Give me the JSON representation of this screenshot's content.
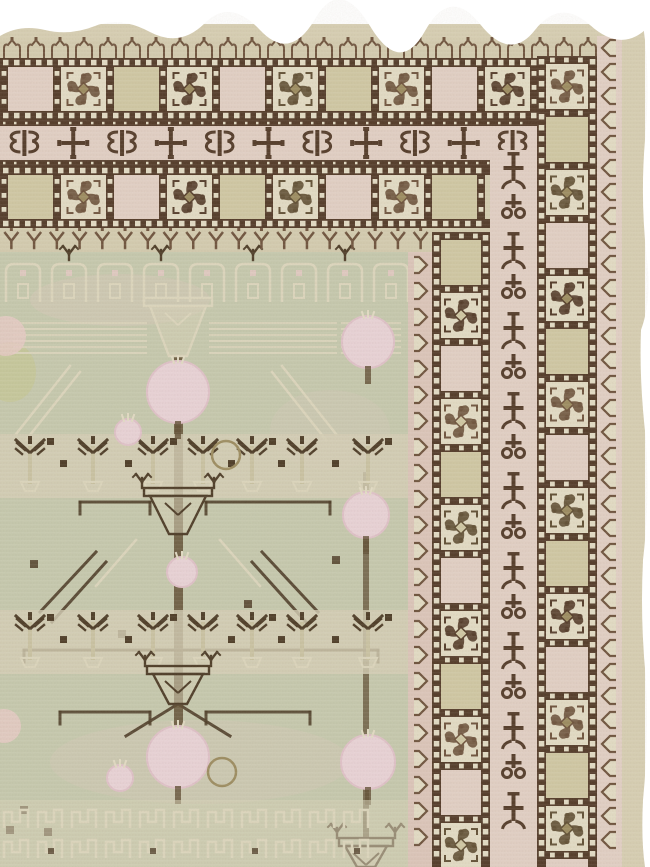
{
  "meta": {
    "subject": "Antique Khotan Samarkand carpet, corner detail",
    "alt": "Corner fragment of an antique pale-green Khotan rug with pomegranate-tree field, pink-ground borders of rosette squares, ribbon meander band and hook guard stripes, ragged white photo edge at top and right"
  },
  "palette": {
    "photo_bg": "#ffffff",
    "cream_edge": "#d7cfb3",
    "cream": "#d4ccb0",
    "cream_light": "#e3dcc5",
    "pink_ground": "#dcc6ba",
    "pink_light": "#e2d0c5",
    "brown_dark": "#523a28",
    "brown_soft": "#6d523c",
    "cell_beige": "#d0c8a4",
    "olive": "#9c8c60",
    "olive_deep": "#5f4e33",
    "field_green": "#c6c9ae",
    "field_cream": "#d6d0b6",
    "line_light": "#dcd6bd",
    "pom_pink": "#e9d3d7",
    "pom_deep": "#e0c2c9",
    "branch_brown": "#4c3b26",
    "blush": "#e6cbc5",
    "moss": "#c6c78e",
    "trunk_light": "#cac3a3"
  },
  "scene": {
    "canvas": {
      "w": 650,
      "h": 867
    },
    "rug": {
      "x": 0,
      "y": 24,
      "w": 645,
      "h": 843
    },
    "top_border": {
      "bands": [
        {
          "name": "fringe-edge",
          "type": "plainH",
          "y": 24,
          "h": 16,
          "right": 645,
          "color": "cream_edge"
        },
        {
          "name": "lappet-guard",
          "type": "lappets",
          "y": 40,
          "h": 20,
          "right": 600,
          "count": 25
        },
        {
          "name": "outer-rosette-square-band",
          "type": "squaresH",
          "y": 58,
          "h": 62,
          "right": 597,
          "period": 53,
          "seq": [
            "pink",
            "rosette",
            "beige",
            "rosette"
          ]
        },
        {
          "name": "ribbon-meander-band",
          "type": "bowties",
          "y": 120,
          "h": 46,
          "right": 537,
          "count": 11
        },
        {
          "name": "inner-rosette-square-band",
          "type": "squaresH",
          "y": 166,
          "h": 62,
          "right": 490,
          "period": 53,
          "seq": [
            "beige",
            "rosette",
            "pink",
            "rosette"
          ]
        },
        {
          "name": "tulip-guard",
          "type": "vees",
          "y": 228,
          "h": 24,
          "right": 432,
          "count": 19
        }
      ]
    },
    "right_border": {
      "bands": [
        {
          "name": "inner-hook-guard",
          "type": "hooksV",
          "x": 408,
          "w": 24,
          "top": 252,
          "open": "left",
          "ground": "pink_ground",
          "step": 26
        },
        {
          "name": "inner-rosette-square-column",
          "type": "squaresV",
          "x": 432,
          "w": 58,
          "top": 232,
          "period": 53,
          "seq": [
            "beige",
            "rosette",
            "pink",
            "rosette"
          ]
        },
        {
          "name": "vine-meander-column",
          "type": "vineV",
          "x": 490,
          "w": 47,
          "top": 150,
          "step": 40
        },
        {
          "name": "outer-rosette-square-column",
          "type": "squaresV",
          "x": 537,
          "w": 60,
          "top": 56,
          "period": 53,
          "seq": [
            "rosette",
            "beige",
            "rosette",
            "pink"
          ]
        },
        {
          "name": "outer-hook-guard",
          "type": "hooksV",
          "x": 597,
          "w": 25,
          "top": 36,
          "open": "right",
          "ground": "pink_light",
          "step": 24
        },
        {
          "name": "selvedge",
          "type": "plainV",
          "x": 622,
          "w": 23,
          "top": 26,
          "color": "cream_edge"
        }
      ]
    },
    "field": {
      "x": 0,
      "y": 252,
      "w": 408,
      "h": 615,
      "motif": "pomegranate-trees",
      "lattice_row": {
        "y": 258,
        "count": 9,
        "step": 46
      },
      "hatch_band": {
        "y": 320,
        "h": 36,
        "segments": [
          [
            14,
            146
          ],
          [
            210,
            336
          ],
          [
            342,
            400
          ]
        ]
      },
      "top_pot": {
        "cx": 178,
        "y": 298,
        "w": 56,
        "h": 58,
        "style": "light"
      },
      "mid_pot": {
        "cx": 178,
        "y": 488,
        "w": 56,
        "h": 46,
        "style": "dark"
      },
      "low_pot": {
        "cx": 178,
        "y": 666,
        "w": 50,
        "h": 38,
        "style": "dark"
      },
      "right_pot": {
        "cx": 366,
        "y": 838,
        "w": 42,
        "h": 29,
        "style": "dark"
      },
      "trunk": {
        "x": 174,
        "w": 9,
        "y1": 356,
        "y2": 758
      },
      "right_trunk": {
        "x": 363,
        "w": 6,
        "y1": 472,
        "y2": 838
      },
      "tree_rows": [
        {
          "baseY": 490,
          "xs": [
            30,
            93,
            153,
            203,
            252,
            302,
            368
          ],
          "squares": [
            60,
            125,
            228,
            278,
            332
          ]
        },
        {
          "baseY": 666,
          "xs": [
            30,
            93,
            153,
            203,
            252,
            302,
            368
          ],
          "squares": [
            60,
            125,
            228,
            278,
            332
          ]
        }
      ],
      "pomegranates": [
        {
          "cx": 178,
          "cy": 392,
          "r": 31,
          "style": "pink"
        },
        {
          "cx": 128,
          "cy": 432,
          "r": 13,
          "style": "pink"
        },
        {
          "cx": 226,
          "cy": 455,
          "r": 14,
          "style": "outline"
        },
        {
          "cx": 368,
          "cy": 342,
          "r": 26,
          "style": "pink"
        },
        {
          "cx": 6,
          "cy": 336,
          "r": 20,
          "style": "blush"
        },
        {
          "cx": 182,
          "cy": 572,
          "r": 15,
          "style": "pink"
        },
        {
          "cx": 366,
          "cy": 515,
          "r": 23,
          "style": "pink"
        },
        {
          "cx": 178,
          "cy": 757,
          "r": 31,
          "style": "pink"
        },
        {
          "cx": 120,
          "cy": 778,
          "r": 13,
          "style": "pink"
        },
        {
          "cx": 222,
          "cy": 772,
          "r": 14,
          "style": "outline"
        },
        {
          "cx": 368,
          "cy": 762,
          "r": 27,
          "style": "pink"
        },
        {
          "cx": 4,
          "cy": 726,
          "r": 17,
          "style": "blush"
        }
      ],
      "hlines": [
        [
          80,
          502,
          150
        ],
        [
          206,
          502,
          330
        ],
        [
          24,
          650,
          378
        ],
        [
          60,
          712,
          150
        ],
        [
          206,
          712,
          310
        ]
      ],
      "diagonals_light": [
        [
          70,
          366,
          16,
          434
        ],
        [
          80,
          372,
          26,
          440
        ],
        [
          282,
          366,
          336,
          434
        ],
        [
          272,
          372,
          326,
          440
        ],
        [
          136,
          540,
          96,
          586
        ],
        [
          220,
          540,
          260,
          586
        ]
      ],
      "diagonals_dark": [
        [
          96,
          552,
          40,
          612
        ],
        [
          106,
          562,
          52,
          622
        ],
        [
          262,
          552,
          318,
          612
        ],
        [
          252,
          562,
          306,
          622
        ],
        [
          178,
          704,
          126,
          736
        ],
        [
          178,
          704,
          230,
          736
        ]
      ],
      "dark_squares": [
        [
          30,
          560
        ],
        [
          118,
          630
        ],
        [
          244,
          600
        ],
        [
          332,
          556
        ],
        [
          20,
          806
        ],
        [
          44,
          828
        ],
        [
          6,
          826
        ]
      ],
      "dense_band": {
        "y": 800,
        "rows": [
          804,
          834
        ],
        "step": 34
      },
      "washes": [
        {
          "cx": 10,
          "cy": 372,
          "rx": 26,
          "ry": 30,
          "color": "moss",
          "o": 0.55
        },
        {
          "cx": 120,
          "cy": 300,
          "rx": 90,
          "ry": 26,
          "color": "blush",
          "o": 0.25
        },
        {
          "cx": 200,
          "cy": 762,
          "rx": 150,
          "ry": 42,
          "color": "blush",
          "o": 0.2
        },
        {
          "cx": 330,
          "cy": 430,
          "rx": 60,
          "ry": 40,
          "color": "blush",
          "o": 0.16
        }
      ]
    }
  }
}
